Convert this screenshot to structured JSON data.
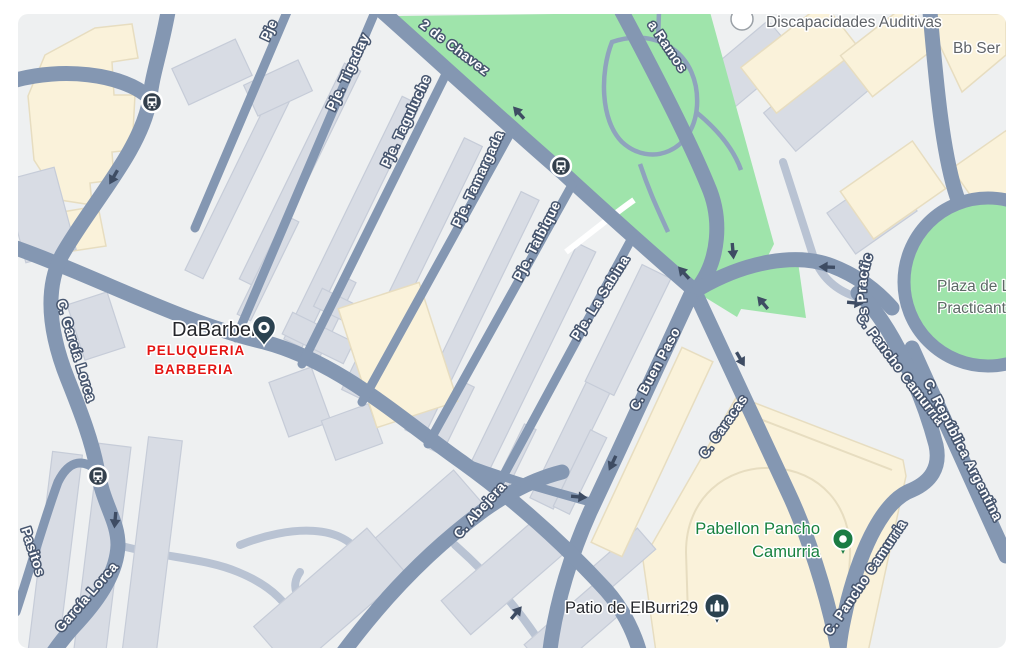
{
  "colors": {
    "land": "#eef0f1",
    "road": "#8497b2",
    "road_light": "#b9c3d3",
    "park": "#9fe4ab",
    "building_gray": "#d8dce4",
    "building_gray_stroke": "#c6ccd8",
    "building_cream": "#faf2da",
    "building_cream_stroke": "#e7ddc0",
    "street_label_fill": "#ffffff",
    "street_label_halo": "#47566f",
    "poi_gray": "#5f6368",
    "poi_dark": "#24262b",
    "poi_green": "#17813e",
    "alert_red": "#e41513",
    "pin_dark": "#2b4250",
    "pin_green": "#1b7c44",
    "arrow": "#3e4c63",
    "bus_icon_bg": "#333f4c"
  },
  "streets": [
    {
      "text": "C. García Lorca"
    },
    {
      "text": "García Lorca"
    },
    {
      "text": "Pasitos"
    },
    {
      "text": "Pje"
    },
    {
      "text": "Pje. Tigaday"
    },
    {
      "text": "Pje. Taguluche"
    },
    {
      "text": "Pje. Tamargada"
    },
    {
      "text": "Pje. Taibique"
    },
    {
      "text": "Pje. La Sabina"
    },
    {
      "text": "2 de Chavez"
    },
    {
      "text": "a Ramos"
    },
    {
      "text": "C. Buen Paso"
    },
    {
      "text": "C. Caracas"
    },
    {
      "text": "C. Abejera"
    },
    {
      "text": "C. Pancho Camurria"
    },
    {
      "text": "C. Pancho Camurria"
    },
    {
      "text": "C. República Argentina"
    },
    {
      "text": "Pl. de Los Practic"
    }
  ],
  "pois": {
    "discapacidades": {
      "label": "Discapacidades Auditivas"
    },
    "bb_ser": {
      "label": "Bb Ser"
    },
    "dabarber": {
      "label": "DaBarber"
    },
    "peluqueria": {
      "line1": "PELUQUERIA",
      "line2": "BARBERIA"
    },
    "pabellon": {
      "line1": "Pabellon Pancho",
      "line2": "Camurria"
    },
    "patio": {
      "label": "Patio de ElBurri29"
    },
    "plaza": {
      "line1": "Plaza de L",
      "line2": "Practicant"
    }
  }
}
